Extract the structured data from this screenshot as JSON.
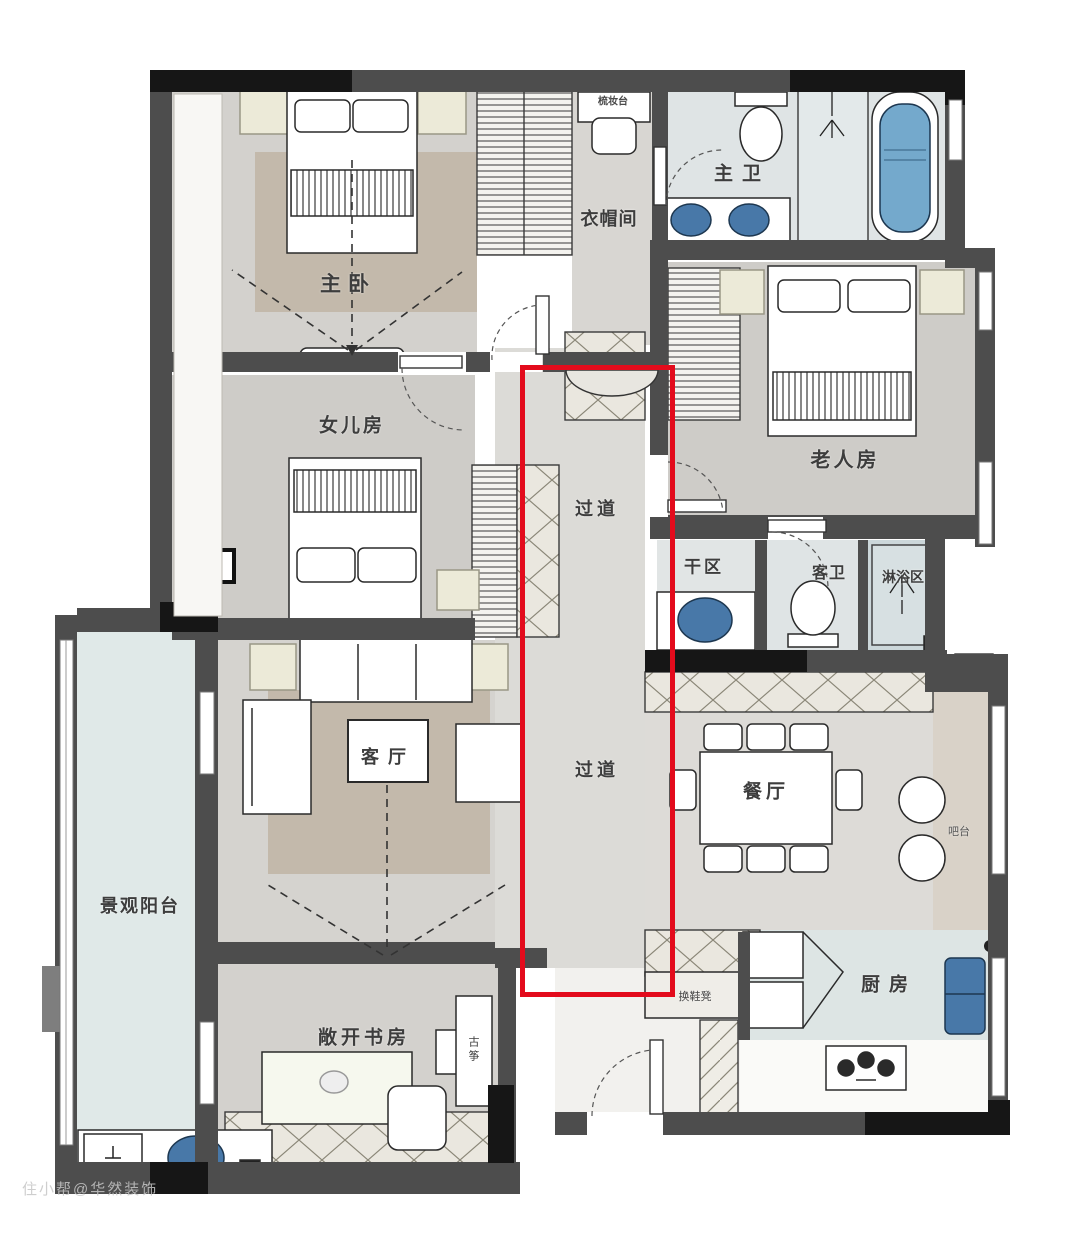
{
  "rooms": {
    "master_bedroom": "主卧",
    "cloakroom": "衣帽间",
    "dresser": "梳妆台",
    "master_bath": "主卫",
    "elder_room": "老人房",
    "daughter_room": "女儿房",
    "corridor_upper": "过道",
    "corridor_lower": "过道",
    "dry_area": "干区",
    "guest_bath": "客卫",
    "shower_area": "淋浴区",
    "living_room": "客厅",
    "dining_room": "餐厅",
    "bar": "吧台",
    "balcony": "景观阳台",
    "study": "敞开书房",
    "guzheng": "古筝",
    "kitchen": "厨房",
    "shoe_bench": "换鞋凳"
  },
  "watermark": "住小帮@华然装饰",
  "colors": {
    "red": "#e30b1c",
    "wall": "#4d4d4d",
    "wall-black": "#161616",
    "fixture-blue": "#4878a8",
    "tub-blue": "#74a9cc",
    "rug": "#c3b9ab",
    "pale-light": "#ecead8"
  }
}
